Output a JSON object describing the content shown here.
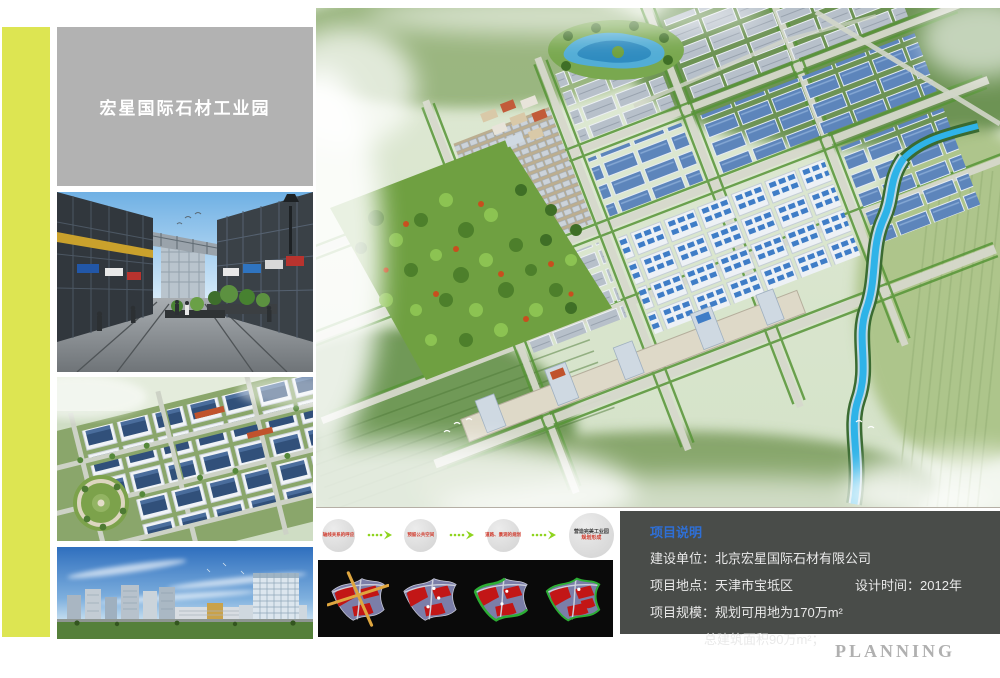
{
  "title_box": {
    "title": "宏星国际石材工业园"
  },
  "flow_steps": [
    {
      "line1": "轴线关系的呼应",
      "line2": ""
    },
    {
      "line1": "预留公共空间",
      "line2": ""
    },
    {
      "line1": "道路、景观的规划",
      "line2": ""
    },
    {
      "line1": "营造完美工业园",
      "line2": "规划形成"
    }
  ],
  "info_box": {
    "header": "项目说明",
    "row1": {
      "label": "建设单位：",
      "value": "北京宏星国际石材有限公司"
    },
    "row2": {
      "label": "项目地点：",
      "value": "天津市宝坻区",
      "extra_label": "设计时间：",
      "extra_value": "2012年"
    },
    "row3": {
      "label": "项目规模：",
      "value": "规划可用地为170万m²"
    },
    "row4": {
      "value": "总建筑面积90万m²；"
    }
  },
  "footer": {
    "watermark": "PLANNING"
  },
  "colors": {
    "accent_stripe": "#dde552",
    "title_box_bg": "#b2b2b2",
    "info_box_bg": "#494c49",
    "info_header_blue": "#2e6fd6",
    "flow_text_red": "#d0392b",
    "arrow_green": "#8fd41f",
    "panel_bg": "#0a0a0a",
    "planning_gray": "#b0b0b0"
  },
  "icons": {
    "flow_arrow": "dotted-arrow-right-icon",
    "diagrams": [
      "site-axis-diagram",
      "site-nodes-diagram",
      "site-greenway-diagram",
      "site-final-plan-diagram"
    ]
  }
}
